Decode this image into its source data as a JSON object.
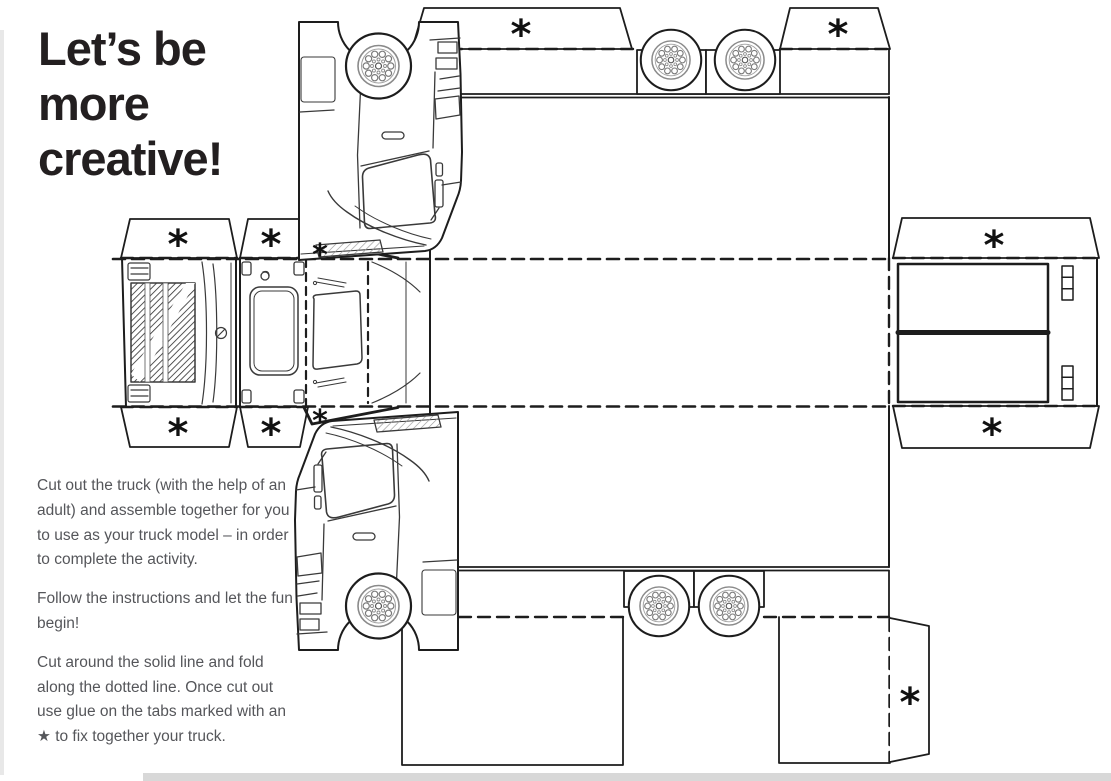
{
  "page": {
    "background": "#ffffff",
    "edge_strip_color": "#e8e8e8",
    "footer_bar_color": "#d8d8d8",
    "line_color": "#1d1d1d",
    "text_color": "#55565a",
    "title_color": "#231f20",
    "title": "Let's be more creative!",
    "title_lines": [
      "Let’s be",
      "more",
      "creative!"
    ],
    "instructions": [
      "Cut out the truck (with the help of an adult) and assemble together for you to use as your truck model – in order to complete the activity.",
      "Follow the instructions and let the fun begin!",
      "Cut around the solid line and fold along the dotted line. Once cut out use glue on the tabs marked with an ★ to fix together your truck."
    ],
    "glue_tab_marker": "*"
  }
}
